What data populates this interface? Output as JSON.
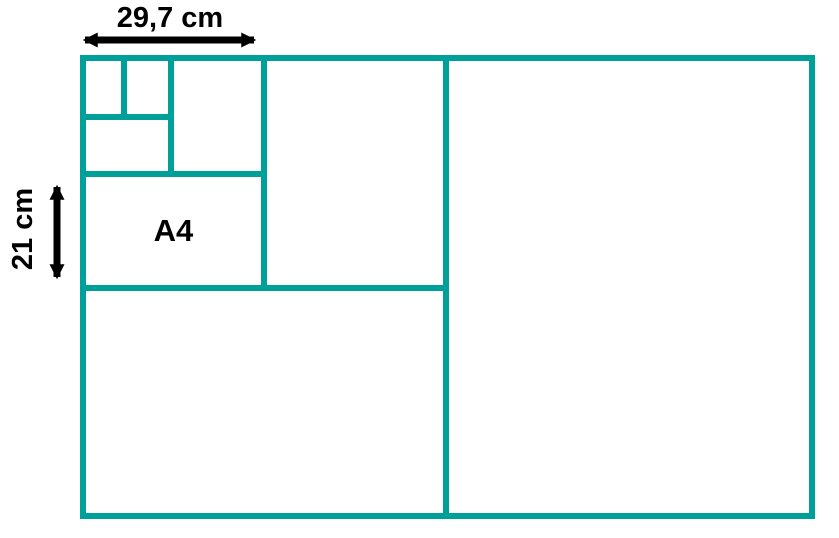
{
  "diagram": {
    "type": "paper-size-subdivision",
    "labels": {
      "width_dimension": "29,7 cm",
      "height_dimension": "21 cm",
      "a4": "A4"
    },
    "icons": {
      "width_arrow": "horizontal-double-headed-arrow",
      "height_arrow": "vertical-double-headed-arrow"
    },
    "colors": {
      "grid_teal": "#00A09A",
      "annotation_black": "#000000",
      "background": "#FFFFFF"
    }
  }
}
